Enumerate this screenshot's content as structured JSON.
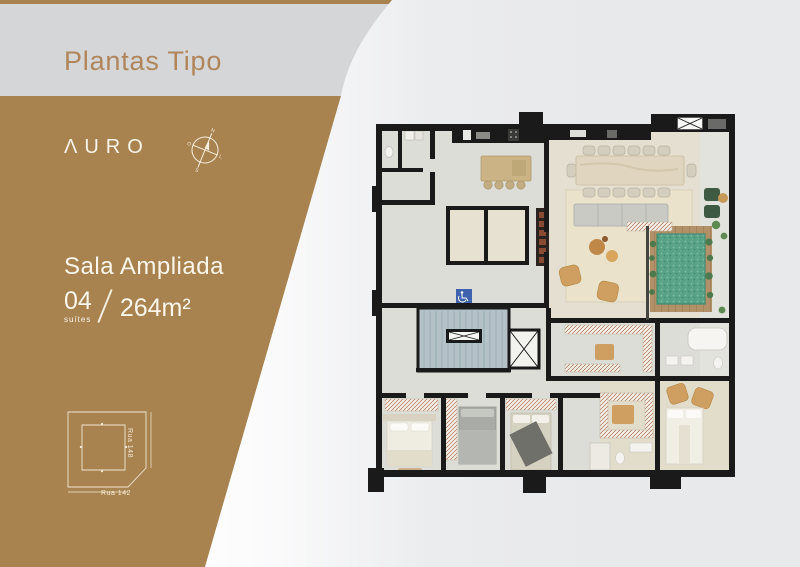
{
  "page": {
    "title": "Plantas Tipo"
  },
  "brand": {
    "logo_text": "ΛURO"
  },
  "compass": {
    "n": "N",
    "s": "S",
    "w": "O",
    "e": "L"
  },
  "plan": {
    "name": "Sala Ampliada",
    "suites_value": "04",
    "suites_label": "suítes",
    "area": "264m²"
  },
  "site_map": {
    "street_bottom": "Rua 142",
    "street_right": "Rua 148"
  },
  "floor_plan": {
    "description": "architectural floor plan, top view, 4-suite apartment with pool terrace",
    "colors": {
      "walls": "#1a1a1a",
      "floor_base": "#dcddd6",
      "floor_living": "#e4dfd0",
      "rug": "#eae2cb",
      "pool": "#58a287",
      "pool_deck": "#b29068",
      "stairs": "#b4c2c8",
      "closet_hatch": "#b26a4a",
      "wood_furniture": "#cf9f62",
      "accessibility_sign": "#3f62ae"
    }
  },
  "colors": {
    "brand_brown": "#a8834f",
    "title_bronze": "#b1855a",
    "header_gray": "#d4d6d8",
    "background_gray": "#e9eaec",
    "cream_text": "#f8f4ea"
  }
}
